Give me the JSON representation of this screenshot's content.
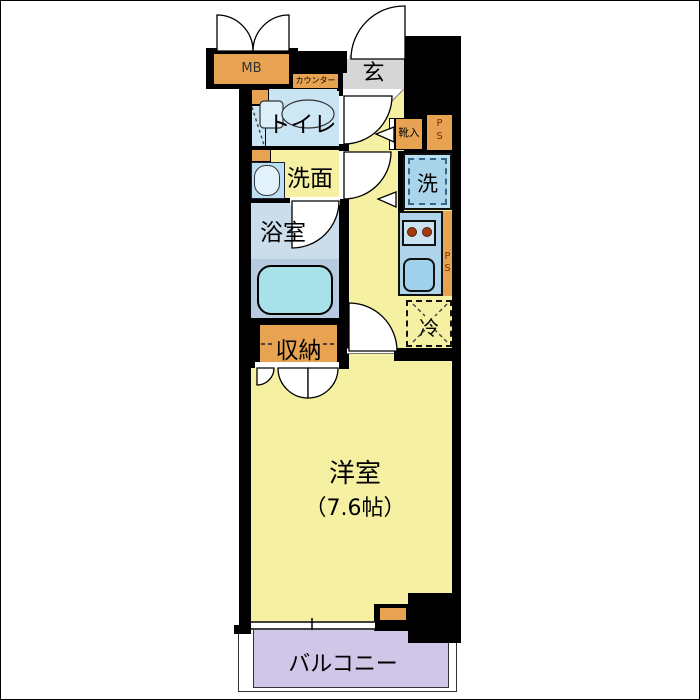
{
  "plan": {
    "labels": {
      "mb": "MB",
      "counter": "カウンター",
      "entrance": "玄",
      "toilet": "トイレ",
      "washroom": "洗面",
      "bathroom": "浴室",
      "storage": "収納",
      "shoe_cabinet": "靴入",
      "washer": "洗",
      "fridge": "冷",
      "western_room": "洋室",
      "western_room_size": "（7.6帖）",
      "balcony": "バルコニー",
      "pipe_space_p": "P",
      "pipe_space_s": "S"
    },
    "colors": {
      "wall_black": "#000000",
      "room_yellow": "#F5F0A2",
      "fixture_orange": "#E8A352",
      "water_blue": "#C9E5F3",
      "kitchen_blue": "#AFD4EA",
      "bath_upper_blue": "#CBDCEA",
      "bath_lower_blue": "#B6CBDF",
      "tub_cyan": "#A8E2E8",
      "entrance_gray": "#D6D6D6",
      "balcony_purple": "#CFC6E8",
      "ps_text_brown": "#7A2E08",
      "burner_rust": "#A23B12"
    }
  }
}
